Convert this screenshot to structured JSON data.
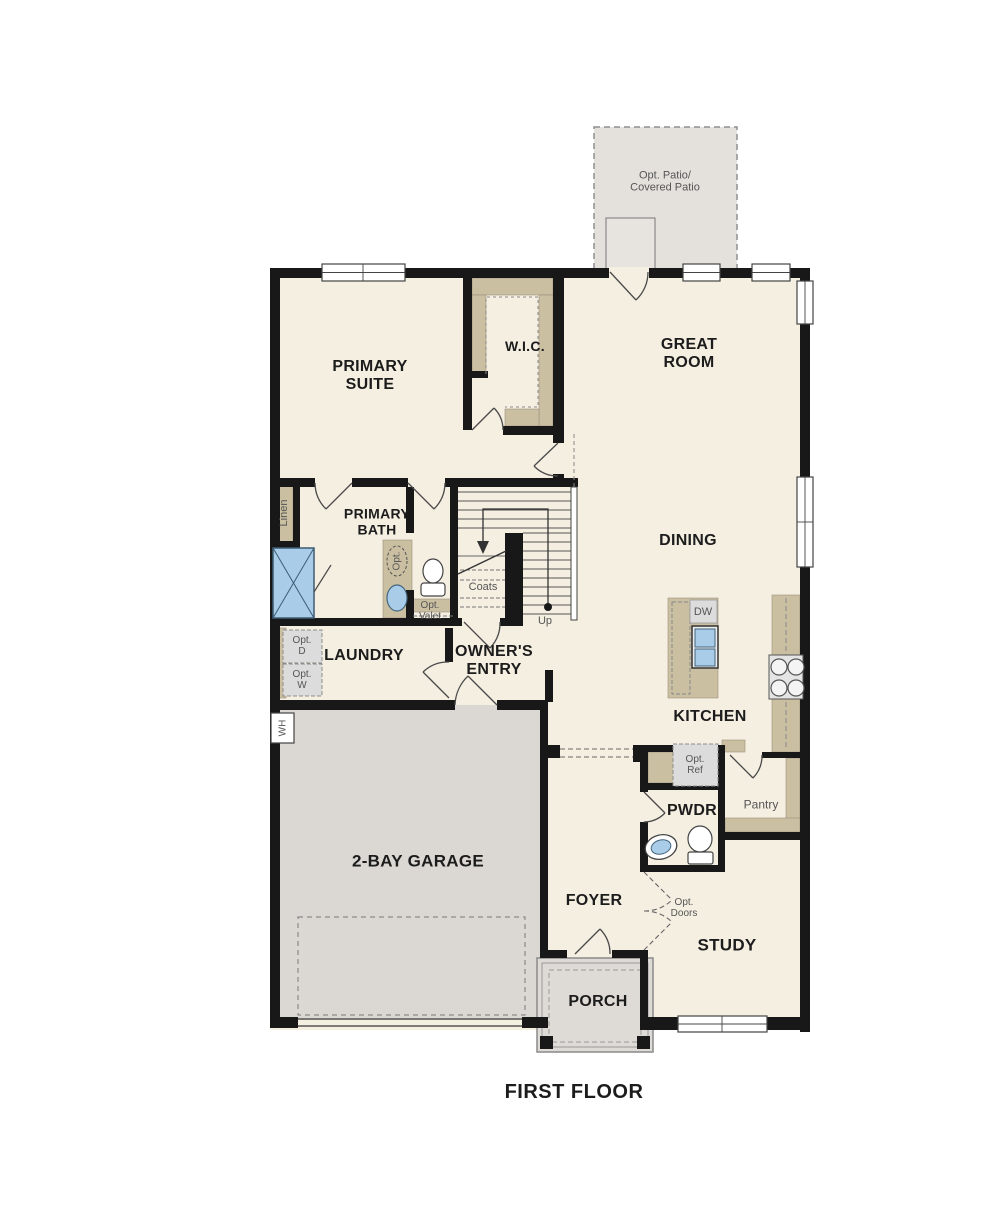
{
  "title": {
    "floor_label": "FIRST FLOOR"
  },
  "rooms": {
    "primary_suite": "PRIMARY\nSUITE",
    "wic": "W.I.C.",
    "great_room": "GREAT\nROOM",
    "primary_bath": "PRIMARY\nBATH",
    "dining": "DINING",
    "laundry": "LAUNDRY",
    "owners_entry": "OWNER'S\nENTRY",
    "kitchen": "KITCHEN",
    "pwdr": "PWDR",
    "garage": "2-BAY GARAGE",
    "foyer": "FOYER",
    "study": "STUDY",
    "porch": "PORCH",
    "pantry": "Pantry"
  },
  "annotations": {
    "patio": "Opt. Patio/\nCovered Patio",
    "linen": "Linen",
    "coats": "Coats",
    "up": "Up",
    "opt_valet": "Opt.\nValet",
    "opt_d": "Opt.\nD",
    "opt_w": "Opt.\nW",
    "opt_sink": "Opt.",
    "dw": "DW",
    "opt_ref": "Opt.\nRef",
    "opt_doors": "Opt.\nDoors",
    "wh": "WH"
  },
  "colors": {
    "floor": "#f5efe2",
    "wall": "#181818",
    "cabinet_tan": "#cbbfa2",
    "garage_gray": "#dbd8d3",
    "patio_gray": "#e4e1dd",
    "porch_gray": "#dedbd7",
    "fixture_blue": "#a9cde8",
    "appliance_gray": "#dcdcdc"
  }
}
